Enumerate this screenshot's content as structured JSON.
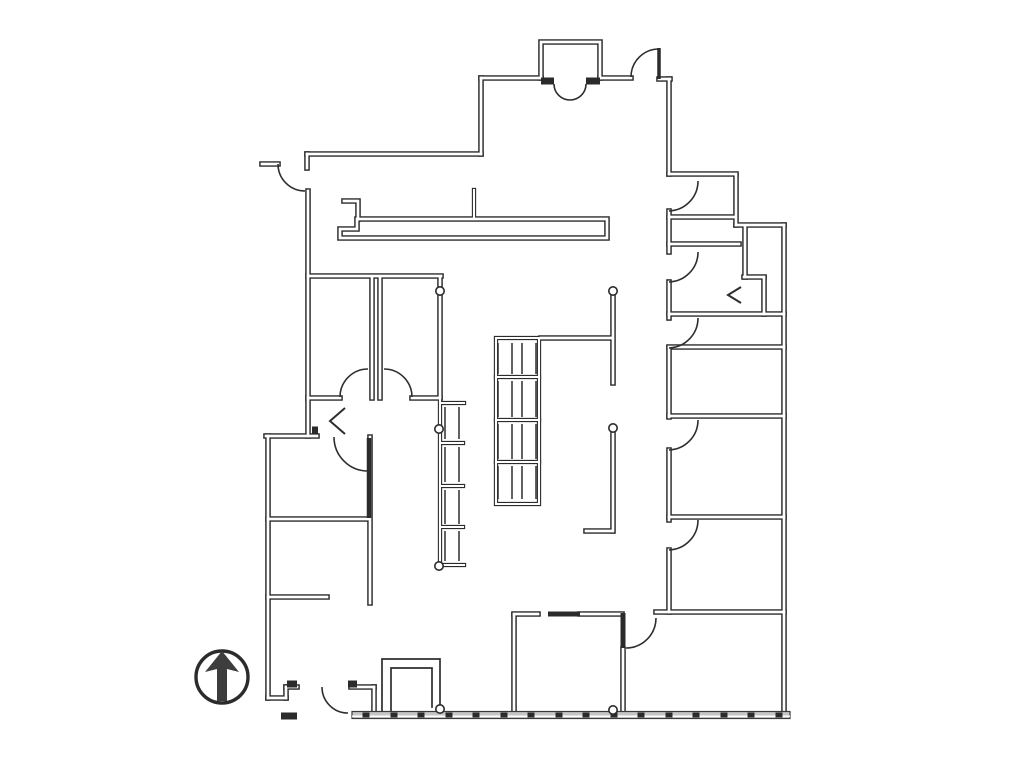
{
  "title": "floor-plan-drawing",
  "canvas": {
    "width": 1024,
    "height": 771,
    "background": "#ffffff"
  },
  "colors": {
    "wall": "#2b2b2b",
    "wall_core": "#ffffff",
    "thin": "#2e2e2e",
    "arrow": "#3d3d3d",
    "glass_fill": "#c6c6c6",
    "glass_edge": "#3a3a3a"
  },
  "walls": [
    "M262,164 H278",
    "M307,168 V154",
    "M307,154 H481",
    "M481,154 V78",
    "M481,78 H541",
    "M541,78 V42 H600 V78",
    "M600,78 H631",
    "M659,79 H670",
    "M669,79 V174",
    "M669,174 H736",
    "M736,176 V225",
    "M736,225 H784",
    "M784,225 V714",
    "M669,211 V252",
    "M669,282 V318",
    "M669,348 V417",
    "M669,450 V520",
    "M669,550 V612",
    "M669,217 H735",
    "M669,244 H739",
    "M669,314 H784",
    "M745,227 V277",
    "M744,277 H764",
    "M764,278 V314",
    "M669,347 H784",
    "M669,416 H784",
    "M669,517 H784",
    "M656,612 H784",
    "M623,649 V714",
    "M514,614 H538",
    "M580,614 H622",
    "M514,615 V714",
    "M308,191 V436",
    "M266,436 H317",
    "M268,436 V698",
    "M268,698 H286",
    "M286,698 V687",
    "M286,687 H297",
    "M351,687 H374",
    "M374,687 V714",
    "M370,437 V603",
    "M268,519 H369",
    "M268,597 H327",
    "M308,276 H441",
    "M372,278 V398",
    "M380,278 V398",
    "M440,278 V397",
    "M308,398 H340",
    "M412,398 H440",
    "M357,219 H607 V238 H340 V229 H357 Z",
    "M344,201 H358 V219",
    "M613,296 V383",
    "M541,338 H612",
    "M613,432 V531",
    "M586,531 H612"
  ],
  "lite_walls": [
    "M440,398 V568",
    "M474,190 V219",
    "M496,338 H539 V504 H496 Z",
    "M496,377 H539",
    "M496,420 H539",
    "M496,462 H539",
    "M441,403 H464",
    "M441,443 H463",
    "M441,486 H463",
    "M441,527 H463",
    "M441,565 H464"
  ],
  "thin_lines": [
    "M382,713 V659 H440 V707",
    "M391,713 V668 H432 V707"
  ],
  "shelving": {
    "gondola": {
      "cols": [
        [
          498,
          512
        ],
        [
          522,
          536
        ]
      ],
      "rows": [
        [
          343,
          374
        ],
        [
          381,
          417
        ],
        [
          424,
          459
        ],
        [
          466,
          499
        ]
      ]
    },
    "ladder": {
      "cols": [
        [
          445,
          459
        ]
      ],
      "rows": [
        [
          407,
          439
        ],
        [
          447,
          482
        ],
        [
          490,
          524
        ],
        [
          531,
          561
        ]
      ]
    }
  },
  "arcs": [
    "M278,164 A27,27 0 0 0 305,191",
    "M554,84 A16,16 0 0 0 570,100",
    "M586,84 A16,16 0 0 1 570,100",
    "M631,77 A28,28 0 0 1 659,49",
    "M698,181 A30,30 0 0 1 669,211",
    "M698,252 A30,30 0 0 1 669,282",
    "M698,318 A30,30 0 0 1 669,348",
    "M698,420 A30,30 0 0 1 669,450",
    "M698,520 A30,30 0 0 1 669,550",
    "M626,648 A30,30 0 0 0 656,618",
    "M334,437 A34,34 0 0 0 368,471",
    "M340,397 A28,28 0 0 1 368,369",
    "M412,397 A28,28 0 0 0 384,369",
    "M322,687 A26,26 0 0 0 348,713"
  ],
  "bifold_doors": [
    "M345,408 L330,421 L345,434",
    "M741,287 L728,295 L741,303"
  ],
  "dark_segments": [
    {
      "d": "M541,81 H554",
      "w": 7
    },
    {
      "d": "M586,81 H600",
      "w": 7
    },
    {
      "d": "M659,48 V79",
      "w": 3.5
    },
    {
      "d": "M369,438 V518",
      "w": 4.5
    },
    {
      "d": "M548,614 H580",
      "w": 5
    },
    {
      "d": "M623,613 V648",
      "w": 5
    },
    {
      "d": "M287,684 H297",
      "w": 7
    },
    {
      "d": "M348,684 H357",
      "w": 7
    },
    {
      "d": "M281,716 H297",
      "w": 7
    },
    {
      "d": "M312,430 H318",
      "w": 7
    }
  ],
  "posts": [
    [
      440,
      291
    ],
    [
      613,
      291
    ],
    [
      613,
      428
    ],
    [
      439,
      429
    ],
    [
      439,
      566
    ],
    [
      440,
      709
    ],
    [
      613,
      710
    ]
  ],
  "post_radius": 4.2,
  "storefront": {
    "x1": 352,
    "x2": 790,
    "y": 711.5,
    "height": 7,
    "tick_xs": [
      366,
      394,
      421,
      449,
      476,
      504,
      531,
      559,
      586,
      614,
      641,
      669,
      696,
      724,
      751,
      779
    ],
    "tick_w": 7,
    "tick_h": 5
  },
  "north_arrow": {
    "cx": 222,
    "cy": 677,
    "r": 26,
    "ring_width": 3.4,
    "polygon": [
      [
        222,
        651
      ],
      [
        239,
        672
      ],
      [
        227,
        669
      ],
      [
        227,
        701
      ],
      [
        217,
        701
      ],
      [
        217,
        669
      ],
      [
        205,
        672
      ]
    ]
  }
}
